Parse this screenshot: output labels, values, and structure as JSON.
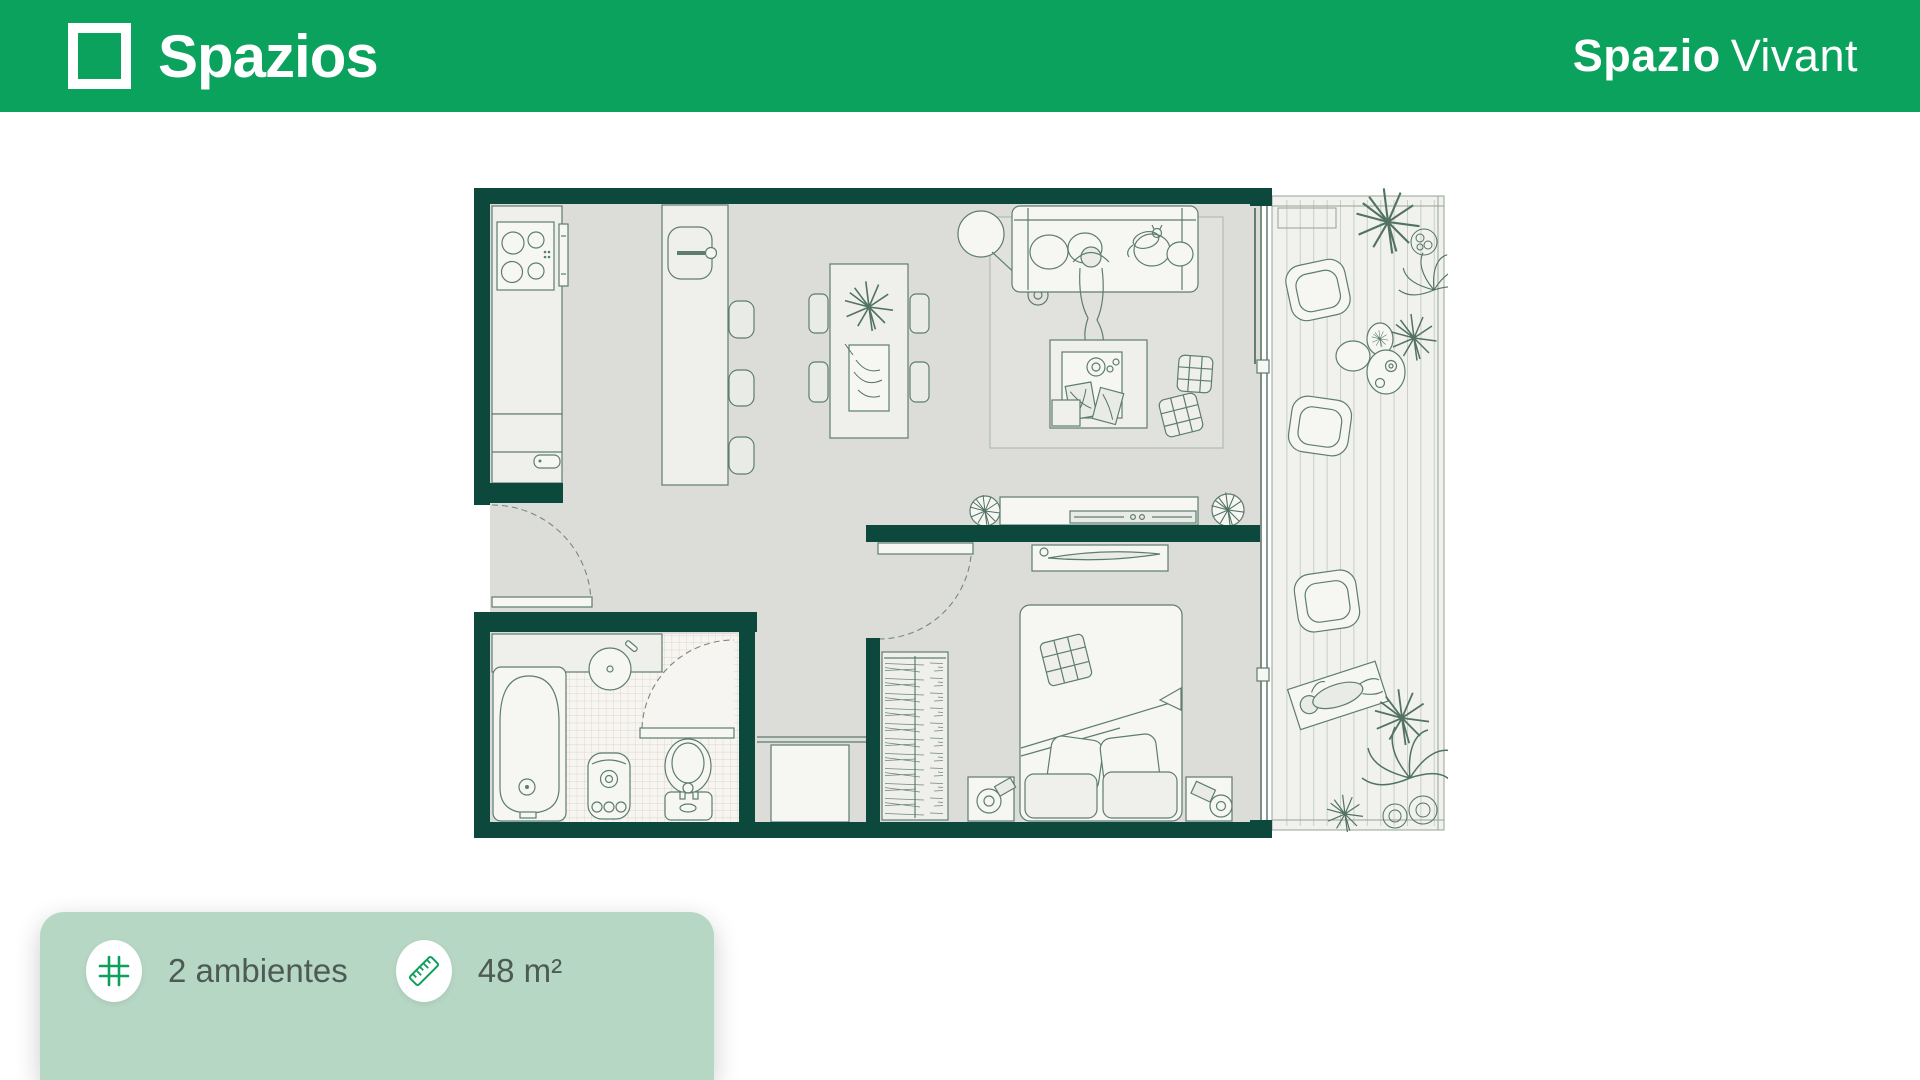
{
  "header": {
    "brand": "Spazios",
    "logo_icon": "square-frame-logo",
    "project_title_bold": "Spazio",
    "project_title_light": "Vivant"
  },
  "info_card": {
    "items": [
      {
        "icon": "floorplan-grid-icon",
        "label": "2 ambientes"
      },
      {
        "icon": "ruler-icon",
        "label": "48 m²"
      }
    ]
  },
  "floor_plan": {
    "description": "apartment top view",
    "rooms": [
      "kitchen",
      "living-dining",
      "bedroom",
      "bathroom",
      "hallway-closet",
      "balcony"
    ]
  },
  "colors": {
    "header_green": "#0aa25d",
    "wall_teal": "#0d483c",
    "floor_gray": "#dcddd9",
    "balcony_floor": "#f1f1ed",
    "card_sage": "#b7d7c5",
    "icon_green": "#0ba05e",
    "label_gray": "#4d5a55"
  }
}
